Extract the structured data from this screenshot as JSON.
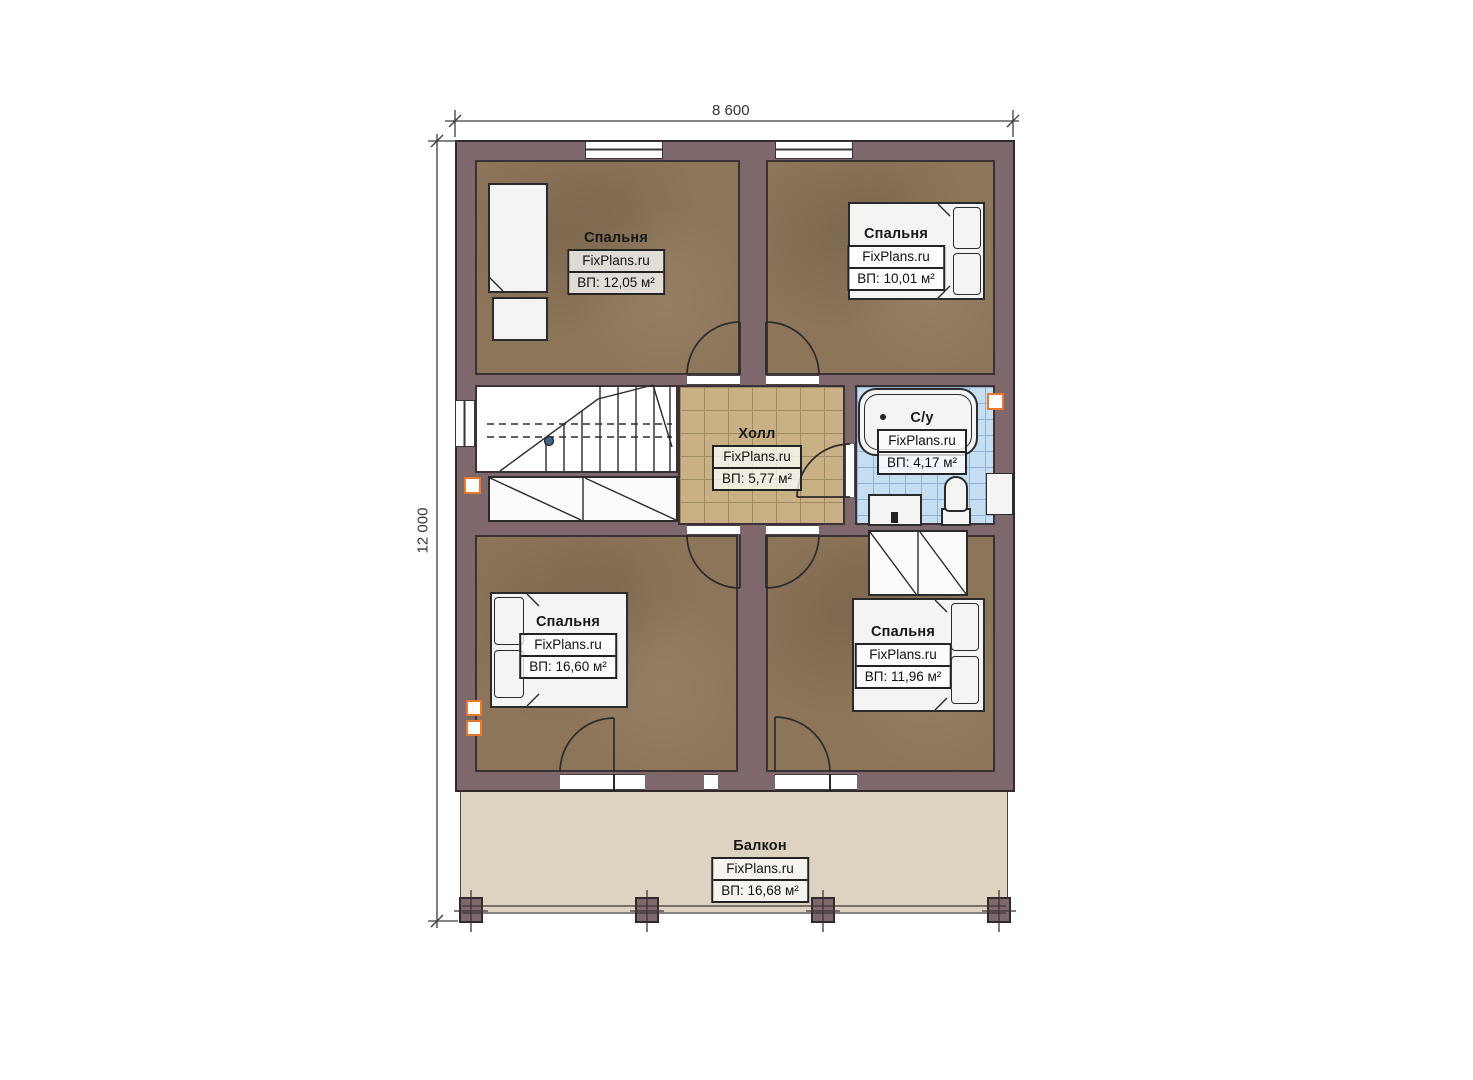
{
  "plan": {
    "dimensions": {
      "width": "8 600",
      "height": "12 000"
    },
    "rooms": [
      {
        "id": "bedroom-top-left",
        "name": "Спальня",
        "watermark": "FixPlans.ru",
        "area": "ВП: 12,05 м²"
      },
      {
        "id": "bedroom-top-right",
        "name": "Спальня",
        "watermark": "FixPlans.ru",
        "area": "ВП: 10,01 м²"
      },
      {
        "id": "hall",
        "name": "Холл",
        "watermark": "FixPlans.ru",
        "area": "ВП: 5,77 м²"
      },
      {
        "id": "bathroom",
        "name": "С/у",
        "watermark": "FixPlans.ru",
        "area": "ВП: 4,17 м²"
      },
      {
        "id": "bedroom-bottom-left",
        "name": "Спальня",
        "watermark": "FixPlans.ru",
        "area": "ВП: 16,60 м²"
      },
      {
        "id": "bedroom-bottom-right",
        "name": "Спальня",
        "watermark": "FixPlans.ru",
        "area": "ВП: 11,96 м²"
      },
      {
        "id": "balcony",
        "name": "Балкон",
        "watermark": "FixPlans.ru",
        "area": "ВП: 16,68 м²"
      }
    ],
    "colors": {
      "wall": "#7e686b",
      "bedroom_floor": "#8d7559",
      "hall_floor": "#c9b185",
      "bathroom_floor": "#c5def2",
      "balcony_floor": "#ded3c0",
      "vent_accent": "#e8782e",
      "linework": "#2b2b2b"
    }
  }
}
